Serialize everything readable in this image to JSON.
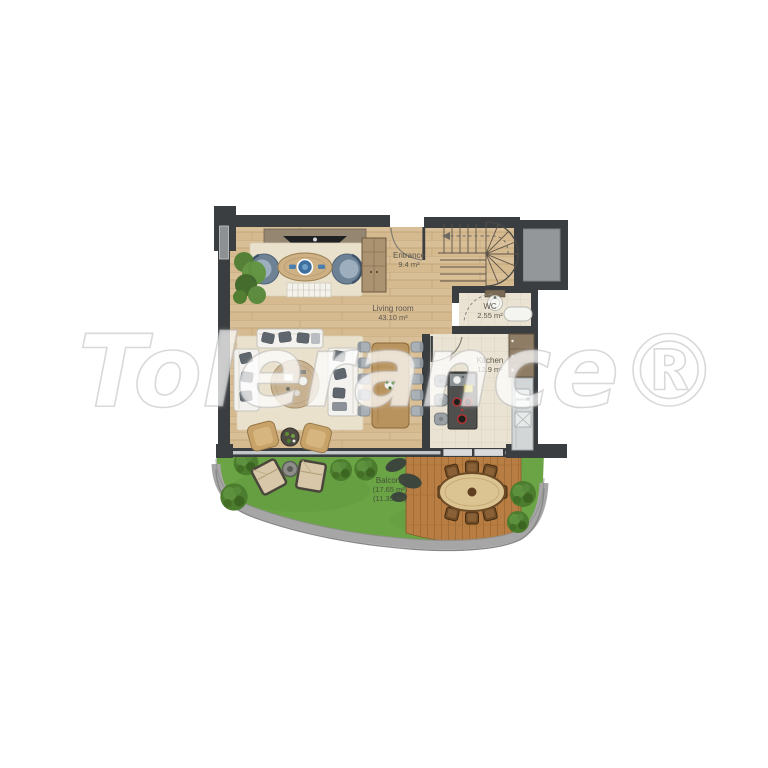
{
  "watermark": {
    "text": "Tolerance®"
  },
  "rooms": {
    "entrance": {
      "label": "Entrance",
      "area": "9.4 m²"
    },
    "living_room": {
      "label": "Living room",
      "area": "43.10 m²"
    },
    "wc": {
      "label": "WC",
      "area": "2.55 m²"
    },
    "kitchen": {
      "label": "Kitchen",
      "area": "12.9 m²"
    },
    "balcony": {
      "label": "Balcony",
      "area1": "(17.65 m²)",
      "area2": "(11.35 m²)"
    }
  },
  "colors": {
    "wall": "#3b3e41",
    "wood_floor": "#d9bf97",
    "tile_floor": "#eae3d3",
    "rug": "#e9e1cc",
    "grass": "#6aa445",
    "deck": "#b87d42",
    "walkway": "#a6a6a6",
    "accent_blue": "#3e6f9e",
    "label_text": "#5a564b"
  }
}
